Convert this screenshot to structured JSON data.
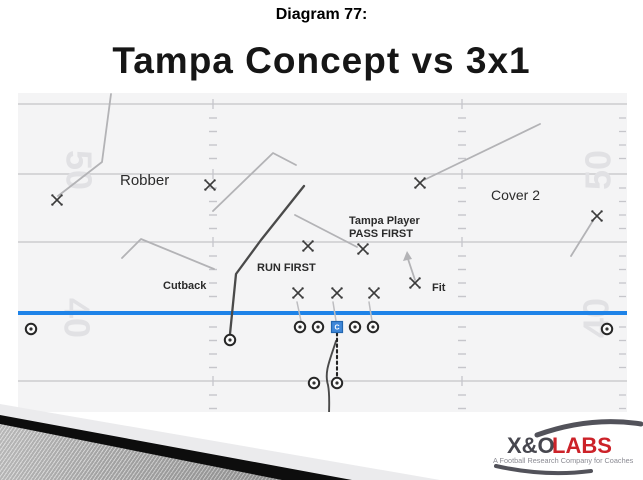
{
  "slide": {
    "subtitle": "Diagram 77:",
    "title": "Tampa Concept vs 3x1"
  },
  "diagram": {
    "field": {
      "bg_color": "#f4f4f5",
      "line_color": "#cbcbcf",
      "hash_color": "#c6c6cb",
      "number_color": "#e1e1e4",
      "los_color": "#1e83e8",
      "x0": 18,
      "x1": 627,
      "y0": 93,
      "y1": 412,
      "yard_lines_y": [
        104,
        174,
        242,
        381
      ],
      "los_y": 313,
      "hash_columns_x": [
        213,
        462
      ],
      "hash_dashes_y": [
        118,
        131.5,
        145,
        158.5,
        188,
        201.5,
        215,
        228.5,
        256,
        269.5,
        283,
        296.5,
        327,
        340.5,
        354,
        367.5,
        395,
        408.5
      ],
      "sideline_ticks_x": 622,
      "yard_numbers": [
        {
          "text": "50",
          "x": 76,
          "y": 170,
          "rot": 90
        },
        {
          "text": "40",
          "x": 74,
          "y": 318,
          "rot": 90
        },
        {
          "text": "50",
          "x": 601,
          "y": 170,
          "rot": -90
        },
        {
          "text": "40",
          "x": 599,
          "y": 318,
          "rot": -90
        }
      ]
    },
    "labels": [
      {
        "text": "Robber",
        "x": 120,
        "y": 185,
        "size": 15,
        "weight": "400"
      },
      {
        "text": "Cover 2",
        "x": 491,
        "y": 200,
        "size": 14,
        "weight": "400"
      },
      {
        "text": "Tampa Player",
        "x": 349,
        "y": 224,
        "size": 11,
        "weight": "600"
      },
      {
        "text": "PASS FIRST",
        "x": 349,
        "y": 237,
        "size": 11,
        "weight": "600"
      },
      {
        "text": "RUN FIRST",
        "x": 257,
        "y": 271,
        "size": 11,
        "weight": "600"
      },
      {
        "text": "Cutback",
        "x": 163,
        "y": 289,
        "size": 11,
        "weight": "600"
      },
      {
        "text": "Fit",
        "x": 432,
        "y": 291,
        "size": 11,
        "weight": "600"
      }
    ],
    "defenders": [
      {
        "name": "corner-left",
        "x": 57,
        "y": 200
      },
      {
        "name": "robber-safety",
        "x": 210,
        "y": 185
      },
      {
        "name": "safety-right",
        "x": 420,
        "y": 183
      },
      {
        "name": "corner-right",
        "x": 597,
        "y": 216
      },
      {
        "name": "lb-run-first",
        "x": 308,
        "y": 246
      },
      {
        "name": "lb-tampa",
        "x": 363,
        "y": 249
      },
      {
        "name": "dl-left",
        "x": 298,
        "y": 293
      },
      {
        "name": "dl-nose",
        "x": 337,
        "y": 293
      },
      {
        "name": "dl-right",
        "x": 374,
        "y": 293
      },
      {
        "name": "fit-defender",
        "x": 415,
        "y": 283
      }
    ],
    "offense": {
      "circles": [
        {
          "name": "wr-left",
          "x": 31,
          "y": 329
        },
        {
          "name": "wr-right",
          "x": 607,
          "y": 329
        },
        {
          "name": "slot-back",
          "x": 230,
          "y": 340
        },
        {
          "name": "left-tackle",
          "x": 300,
          "y": 327
        },
        {
          "name": "left-guard",
          "x": 318,
          "y": 327
        },
        {
          "name": "right-guard",
          "x": 355,
          "y": 327
        },
        {
          "name": "right-tackle",
          "x": 373,
          "y": 327
        },
        {
          "name": "running-back",
          "x": 314,
          "y": 383
        },
        {
          "name": "quarterback",
          "x": 337,
          "y": 383
        }
      ],
      "center_square": {
        "x": 337,
        "y": 327,
        "label": "C",
        "fill": "#3f87d9",
        "stroke": "#2266b0"
      }
    },
    "routes": [
      {
        "name": "corner-left-route",
        "d": "M58,196 L102,162 L111,94",
        "color": "#b3b3b6",
        "w": 1.8
      },
      {
        "name": "robber-route",
        "d": "M213,211 L273,153 L296,165",
        "color": "#b3b3b6",
        "w": 1.8
      },
      {
        "name": "cutback-pointer",
        "d": "M122,258 L141,239 L214,269",
        "color": "#b3b3b6",
        "w": 1.8
      },
      {
        "name": "safety-right-route",
        "d": "M424,180 L540,124",
        "color": "#b3b3b6",
        "w": 1.8
      },
      {
        "name": "corner-right-route",
        "d": "M594,219 L571,256",
        "color": "#b3b3b6",
        "w": 1.8
      },
      {
        "name": "tampa-drop",
        "d": "M295,215 L357,247",
        "color": "#b3b3b6",
        "w": 1.8
      },
      {
        "name": "fit-arrow",
        "d": "M415,280 L407,256",
        "color": "#b3b3b6",
        "w": 1.8
      },
      {
        "name": "fit-arrowhead",
        "d": "M407,251 L403,261 L412,259 Z",
        "color": "#b3b3b6",
        "fill": true
      },
      {
        "name": "block-line-1",
        "d": "M301,321 L297,302",
        "color": "#bdbdc0",
        "w": 1.5
      },
      {
        "name": "block-line-2",
        "d": "M336,321 L333,302",
        "color": "#bdbdc0",
        "w": 1.5
      },
      {
        "name": "block-line-3",
        "d": "M372,321 L369,302",
        "color": "#bdbdc0",
        "w": 1.5
      },
      {
        "name": "slot-deep-route",
        "d": "M230,334 L236,274 L261,240 L304,186",
        "color": "#4a4a4a",
        "w": 2.3
      },
      {
        "name": "qb-run-path",
        "d": "M336,341 C330,360 324,372 328,385 C330,395 329,406 329,417",
        "color": "#4a4a4a",
        "w": 1.9
      },
      {
        "name": "snap-dotted-line",
        "d": "M337,333 L337,377",
        "color": "#222222",
        "w": 2.1,
        "dash": "2.5 3.2"
      }
    ]
  },
  "logo": {
    "part1": "X&O",
    "part2": "LABS",
    "tagline": "A Football Research Company for Coaches",
    "part1_color": "#47474f",
    "part2_color": "#cc2229",
    "tagline_color": "#8b8b93",
    "swoosh_color": "#52525a"
  }
}
